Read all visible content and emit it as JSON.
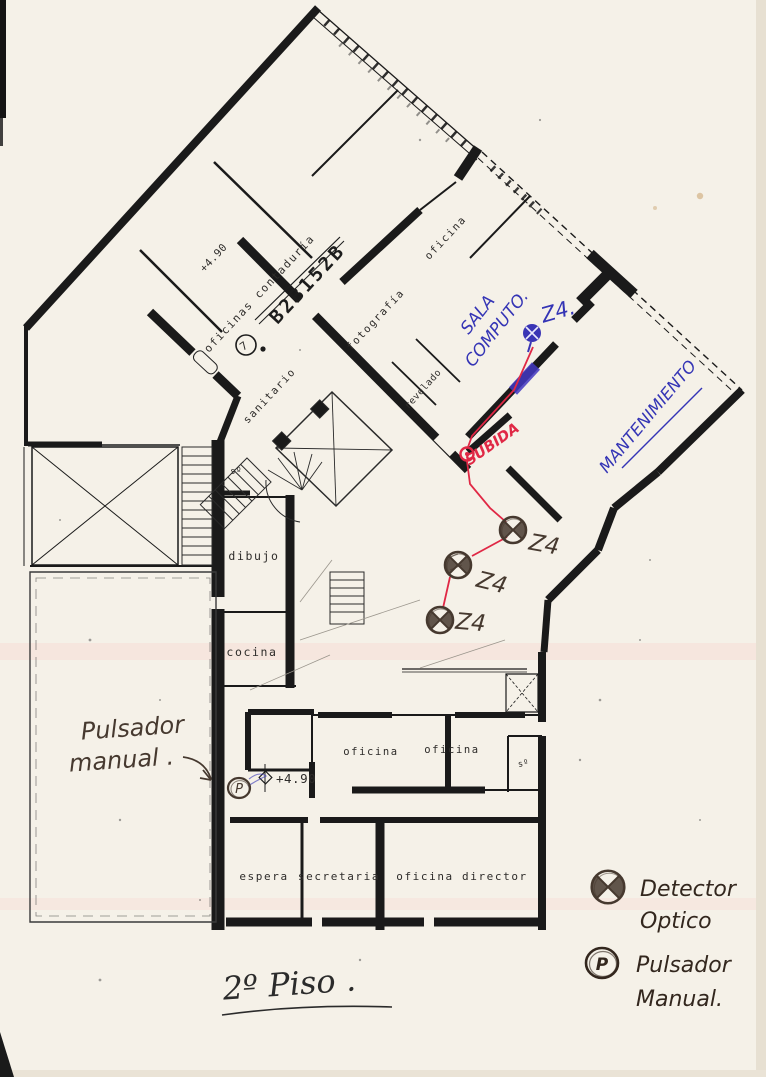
{
  "page": {
    "floor_title": "2º Piso ."
  },
  "plan_labels": {
    "oficinas_contaduria": "oficinas contaduría",
    "stamp_code": "B2B152B",
    "stamp_figure": "7",
    "level_upper": "+4.90",
    "oficina_top": "oficina",
    "fotografia": "fotografía",
    "revelado": "revelado",
    "sanitario": "sanitario",
    "s_small_upper": "sº",
    "dibujo": "dibujo",
    "cocina": "cocina",
    "oficina_mid_left": "oficina",
    "oficina_mid_right": "oficina",
    "s_small_lower": "sº",
    "level_lower": "+4.90",
    "espera": "espera",
    "secretaria": "secretaria",
    "oficina_director": "oficina director"
  },
  "annotations_blue": {
    "sala_line1": "SALA",
    "sala_line2": "COMPUTO.",
    "zone": "Z4.",
    "mantenimiento": "MANTENIMIENTO"
  },
  "annotations_red": {
    "subida": "SUBIDA"
  },
  "annotations_pencil": {
    "zone_d1": "Z4",
    "zone_d2": "Z4",
    "zone_d3": "Z4",
    "note_line1": "Pulsador",
    "note_line2": "manual .",
    "p_letter": "P"
  },
  "legend": {
    "detector_line1": "Detector",
    "detector_line2": "Optico",
    "pulsador_line1": "Pulsador",
    "pulsador_line2": "Manual.",
    "p_letter": "P"
  },
  "colors": {
    "paper": "#f5f1e8",
    "ink": "#1a1a1a",
    "blue": "#3434b5",
    "red": "#e02845",
    "pencil": "#46392f"
  }
}
